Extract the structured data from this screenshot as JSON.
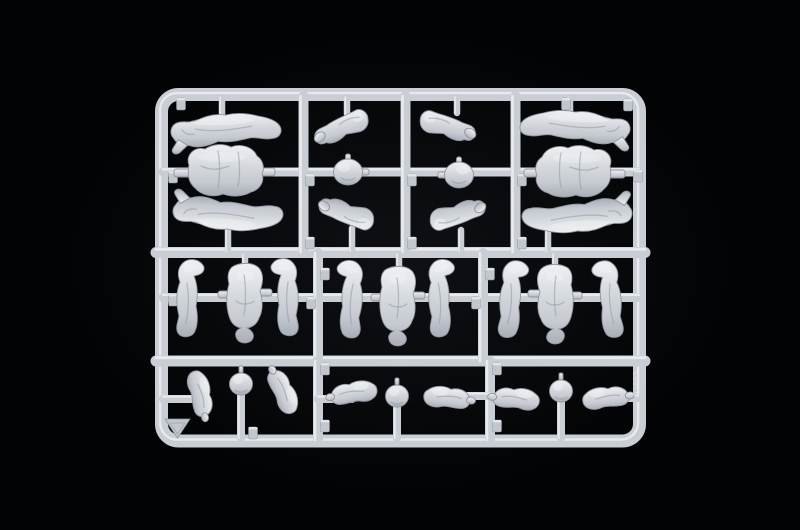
{
  "meta": {
    "description": "Macro photograph of a light-grey injection-moulded polystyrene model-kit sprue (runner frame) holding small-scale toy soldier figure parts, centred on a pure black background",
    "subject": "plastic model kit sprue with figure parts",
    "parts_summary": {
      "leg_pieces": 10,
      "torso_pieces": 5,
      "arm_pieces": 10,
      "head_pieces": 5
    }
  },
  "image": {
    "width": 800,
    "height": 530
  },
  "palette": {
    "background": "#020304",
    "glow": "#2a2f3a",
    "plastic_light": "#eff1f4",
    "plastic_base": "#d6dade",
    "plastic_dark": "#a9aeb7",
    "rail_base": "#c9cdd4",
    "rail_highlight": "#eaedf0",
    "rail_shadow": "#81878f",
    "part_edge": "#8f959e",
    "crease": "#9299a2",
    "tab_fill": "#c2c7ce",
    "code_color": "#e3e6ea"
  },
  "sprue": {
    "frame": {
      "x": 161.5,
      "y": 94.5,
      "w": 478,
      "h": 346.5,
      "rx": 17,
      "thickness": 13
    },
    "rails": [
      {
        "name": "h-rail-upper",
        "x1": 156,
        "y1": 252.5,
        "x2": 645,
        "y2": 252.5,
        "w": 11
      },
      {
        "name": "h-rail-lower",
        "x1": 156,
        "y1": 361,
        "x2": 645,
        "y2": 361,
        "w": 11
      },
      {
        "name": "runner-top",
        "x1": 163,
        "y1": 172,
        "x2": 639,
        "y2": 172,
        "w": 9
      },
      {
        "name": "runner-mid",
        "x1": 163,
        "y1": 297.5,
        "x2": 639,
        "y2": 297.5,
        "w": 9
      },
      {
        "name": "v-bar",
        "x1": 303.5,
        "y1": 96,
        "x2": 303.5,
        "y2": 252,
        "w": 10
      },
      {
        "name": "v-bar",
        "x1": 405.5,
        "y1": 96,
        "x2": 405.5,
        "y2": 252,
        "w": 10
      },
      {
        "name": "v-bar",
        "x1": 515.5,
        "y1": 96,
        "x2": 515.5,
        "y2": 252,
        "w": 10
      },
      {
        "name": "v-bar",
        "x1": 318,
        "y1": 253,
        "x2": 318,
        "y2": 361,
        "w": 10
      },
      {
        "name": "v-bar",
        "x1": 483,
        "y1": 253,
        "x2": 483,
        "y2": 361,
        "w": 10
      },
      {
        "name": "v-bar",
        "x1": 318,
        "y1": 361,
        "x2": 318,
        "y2": 440,
        "w": 10
      },
      {
        "name": "v-bar",
        "x1": 490,
        "y1": 361,
        "x2": 490,
        "y2": 440,
        "w": 10
      },
      {
        "name": "runner-seg",
        "x1": 163,
        "y1": 399,
        "x2": 197,
        "y2": 399,
        "w": 8
      },
      {
        "name": "runner-seg",
        "x1": 318,
        "y1": 399,
        "x2": 352,
        "y2": 399,
        "w": 8
      },
      {
        "name": "runner-seg",
        "x1": 452,
        "y1": 396,
        "x2": 490,
        "y2": 396,
        "w": 8
      },
      {
        "name": "runner-seg",
        "x1": 608,
        "y1": 398,
        "x2": 638,
        "y2": 398,
        "w": 8
      }
    ],
    "stubs": [
      {
        "x": 222,
        "y1": 97,
        "y2": 119
      },
      {
        "x": 228,
        "y1": 226,
        "y2": 251
      },
      {
        "x": 347,
        "y1": 97,
        "y2": 114
      },
      {
        "x": 352,
        "y1": 228,
        "y2": 251
      },
      {
        "x": 457,
        "y1": 97,
        "y2": 113
      },
      {
        "x": 461,
        "y1": 230,
        "y2": 251
      },
      {
        "x": 570,
        "y1": 97,
        "y2": 111
      },
      {
        "x": 548,
        "y1": 231,
        "y2": 251
      },
      {
        "x": 245,
        "y1": 254,
        "y2": 272
      },
      {
        "x": 399,
        "y1": 254,
        "y2": 273
      },
      {
        "x": 555,
        "y1": 254,
        "y2": 272
      }
    ],
    "posts": [
      {
        "x": 241,
        "y1": 390,
        "y2": 438
      },
      {
        "x": 397,
        "y1": 402,
        "y2": 438
      },
      {
        "x": 561,
        "y1": 398,
        "y2": 438
      }
    ],
    "tabs": [
      {
        "x": 181,
        "y": 104
      },
      {
        "x": 566,
        "y": 104
      },
      {
        "x": 628,
        "y": 105
      },
      {
        "x": 173,
        "y": 177
      },
      {
        "x": 173,
        "y": 300
      },
      {
        "x": 310,
        "y": 180
      },
      {
        "x": 310,
        "y": 243
      },
      {
        "x": 412,
        "y": 180
      },
      {
        "x": 412,
        "y": 243
      },
      {
        "x": 522,
        "y": 180
      },
      {
        "x": 522,
        "y": 243
      },
      {
        "x": 325,
        "y": 274
      },
      {
        "x": 311,
        "y": 303
      },
      {
        "x": 490,
        "y": 274
      },
      {
        "x": 476,
        "y": 303
      },
      {
        "x": 325,
        "y": 369
      },
      {
        "x": 325,
        "y": 426
      },
      {
        "x": 497,
        "y": 369
      },
      {
        "x": 497,
        "y": 426
      },
      {
        "x": 253,
        "y": 433
      },
      {
        "x": 638,
        "y": 176
      }
    ],
    "parts": [
      {
        "name": "legs-part",
        "type": "legsH",
        "x": 227,
        "y": 131,
        "rot": -2,
        "sx": 1,
        "sy": 1
      },
      {
        "name": "torso-part",
        "type": "torsoH",
        "x": 226,
        "y": 172,
        "rot": 0,
        "sx": 1,
        "sy": 1
      },
      {
        "name": "legs-part",
        "type": "legsH",
        "x": 229,
        "y": 213,
        "rot": 3,
        "sx": 1,
        "sy": -1
      },
      {
        "name": "arm-part",
        "type": "armBent",
        "x": 342,
        "y": 127,
        "rot": -15,
        "sx": 1,
        "sy": 1
      },
      {
        "name": "head-part",
        "type": "headBall",
        "x": 348,
        "y": 172,
        "rot": 0,
        "sx": 1,
        "sy": 1
      },
      {
        "name": "arm-part",
        "type": "armBent",
        "x": 347,
        "y": 214,
        "rot": 10,
        "sx": 1,
        "sy": -1
      },
      {
        "name": "arm-part",
        "type": "armBent",
        "x": 447,
        "y": 126,
        "rot": 8,
        "sx": -1,
        "sy": 1
      },
      {
        "name": "head-part",
        "type": "headBall",
        "x": 459,
        "y": 175,
        "rot": 0,
        "sx": -1,
        "sy": 1
      },
      {
        "name": "arm-part",
        "type": "armBent",
        "x": 457,
        "y": 215,
        "rot": -8,
        "sx": -1,
        "sy": -1
      },
      {
        "name": "legs-part",
        "type": "legsH",
        "x": 574,
        "y": 128,
        "rot": 2,
        "sx": -1,
        "sy": 1
      },
      {
        "name": "torso-part",
        "type": "torsoH",
        "x": 573,
        "y": 173,
        "rot": 0,
        "sx": -1,
        "sy": 1
      },
      {
        "name": "legs-part",
        "type": "legsH",
        "x": 576,
        "y": 215,
        "rot": -3,
        "sx": -1,
        "sy": -1
      },
      {
        "name": "legs-part",
        "type": "legsV",
        "x": 189,
        "y": 299,
        "rot": 0,
        "sx": 1,
        "sy": 1
      },
      {
        "name": "torso-part",
        "type": "torsoV",
        "x": 245,
        "y": 303,
        "rot": 0,
        "sx": 1,
        "sy": 1
      },
      {
        "name": "legs-part",
        "type": "legsV",
        "x": 286,
        "y": 298,
        "rot": 0,
        "sx": -1,
        "sy": 1
      },
      {
        "name": "legs-part",
        "type": "legsV",
        "x": 350,
        "y": 300,
        "rot": 4,
        "sx": -1,
        "sy": 1
      },
      {
        "name": "torso-part",
        "type": "torsoV",
        "x": 398,
        "y": 306,
        "rot": 0,
        "sx": 1,
        "sy": 1
      },
      {
        "name": "legs-part",
        "type": "legsV",
        "x": 441,
        "y": 299,
        "rot": -3,
        "sx": 1,
        "sy": 1
      },
      {
        "name": "legs-part",
        "type": "legsV",
        "x": 512,
        "y": 300,
        "rot": 3,
        "sx": 1,
        "sy": 1
      },
      {
        "name": "torso-part",
        "type": "torsoV",
        "x": 555,
        "y": 304,
        "rot": 0,
        "sx": -1,
        "sy": 1
      },
      {
        "name": "legs-part",
        "type": "legsV",
        "x": 609,
        "y": 300,
        "rot": -4,
        "sx": -1,
        "sy": 1
      },
      {
        "name": "arm-part",
        "type": "armS",
        "x": 199,
        "y": 394,
        "rot": 78,
        "sx": 1,
        "sy": 1
      },
      {
        "name": "head-part",
        "type": "headPost",
        "x": 241,
        "y": 384,
        "rot": 0,
        "sx": 1,
        "sy": 1
      },
      {
        "name": "arm-part",
        "type": "armS",
        "x": 282,
        "y": 392,
        "rot": 64,
        "sx": -1,
        "sy": 1
      },
      {
        "name": "arm-part",
        "type": "armS",
        "x": 354,
        "y": 394,
        "rot": -10,
        "sx": -1,
        "sy": 1
      },
      {
        "name": "head-part",
        "type": "headPost",
        "x": 397,
        "y": 396,
        "rot": 0,
        "sx": 1,
        "sy": 1
      },
      {
        "name": "arm-part",
        "type": "armS",
        "x": 447,
        "y": 399,
        "rot": 6,
        "sx": 1,
        "sy": 1
      },
      {
        "name": "arm-part",
        "type": "armS",
        "x": 516,
        "y": 400,
        "rot": 5,
        "sx": -1,
        "sy": 1
      },
      {
        "name": "head-part",
        "type": "headPost",
        "x": 561,
        "y": 391,
        "rot": 0,
        "sx": 1,
        "sy": 1
      },
      {
        "name": "arm-part",
        "type": "armS",
        "x": 606,
        "y": 399,
        "rot": -6,
        "sx": 1,
        "sy": 1
      }
    ],
    "molded_code": {
      "text": "51005",
      "x": 638,
      "y": 383
    },
    "logo": {
      "x": 177.5,
      "y": 428
    }
  }
}
